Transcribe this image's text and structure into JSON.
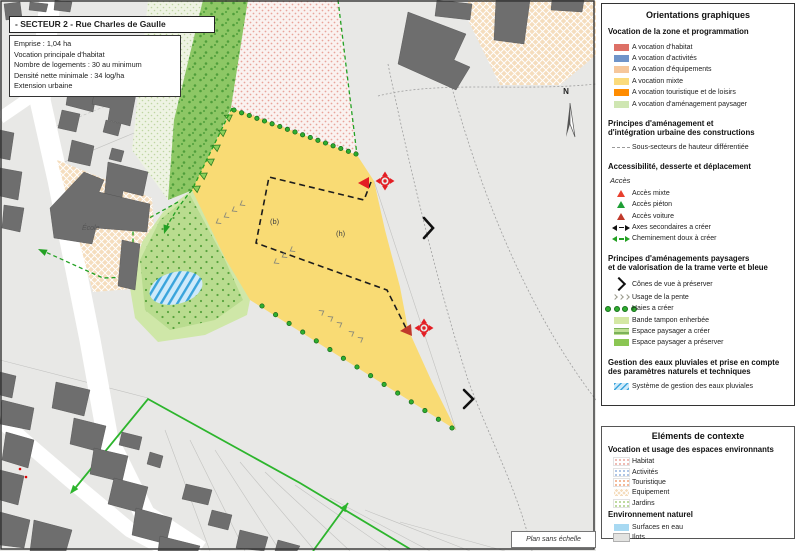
{
  "map": {
    "title": "- SECTEUR 2 - Rue Charles de Gaulle",
    "info_lines": [
      "Emprise : 1,04 ha",
      "Vocation principale d'habitat",
      "Nombre de logements : 30 au minimum",
      "Densité nette minimale : 34 log/ha",
      "Extension urbaine"
    ],
    "labels": {
      "school": "École",
      "sub_b": "(b)",
      "sub_h": "(h)",
      "north": "N",
      "scale_note": "Plan sans échelle"
    }
  },
  "legend": {
    "title": "Orientations graphiques",
    "vocation": {
      "header": "Vocation de la zone et programmation",
      "items": [
        {
          "label": "A vocation d'habitat",
          "color": "#dd7066"
        },
        {
          "label": "A vocation d'activités",
          "color": "#6f94c9"
        },
        {
          "label": "A vocation d'équipements",
          "color": "#f6c79b"
        },
        {
          "label": "A vocation mixte",
          "color": "#fbdb7b"
        },
        {
          "label": "A vocation touristique et de loisirs",
          "color": "#ff8c00"
        },
        {
          "label": "A vocation d'aménagement paysager",
          "color": "#cfe6b2"
        }
      ]
    },
    "principes": {
      "header_line1": "Principes d'aménagement et",
      "header_line2": "d'intégration urbaine des constructions",
      "item": "Sous-secteurs de hauteur différentiée"
    },
    "access": {
      "header": "Accessibilité, desserte et déplacement",
      "subheader": "Accès",
      "items": [
        {
          "label": "Accès mixte",
          "color": "#e8402e"
        },
        {
          "label": "Accès piéton",
          "color": "#1e9e35"
        },
        {
          "label": "Accès voiture",
          "color": "#c0392b"
        },
        {
          "label": "Axes secondaires a créer"
        },
        {
          "label": "Cheminement doux à créer"
        }
      ]
    },
    "paysager": {
      "header_line1": "Principes d'aménagements paysagers",
      "header_line2": "et de valorisation de la trame verte et bleue",
      "items": [
        "Cônes de vue à préserver",
        "Usage de la pente",
        "Haies a créer",
        "Bande tampon enherbée",
        "Espace paysager a créer",
        "Espace paysager a préserver"
      ]
    },
    "eaux": {
      "header_line1": "Gestion des eaux pluviales et prise en compte",
      "header_line2": "des paramètres naturels et techniques",
      "item": "Système de gestion des eaux pluviales"
    }
  },
  "context": {
    "title": "Eléments de contexte",
    "vocation_header": "Vocation et usage des espaces environnants",
    "vocation_items": [
      "Habitat",
      "Activités",
      "Touristique",
      "Equipement",
      "Jardins"
    ],
    "nature_header": "Environnement naturel",
    "nature_items": [
      "Surfaces en eau",
      "Ilots"
    ]
  },
  "colors": {
    "zone_mixte_yellow": "#f9db74",
    "espace_preserver_green": "#8dc765",
    "espace_creer_green": "#bfe095",
    "water_blue": "#3aa4dc",
    "access_red": "#e31e24",
    "path_green": "#23a123",
    "building_gray": "#6e6e6e",
    "background_gray": "#e8e8e6"
  }
}
